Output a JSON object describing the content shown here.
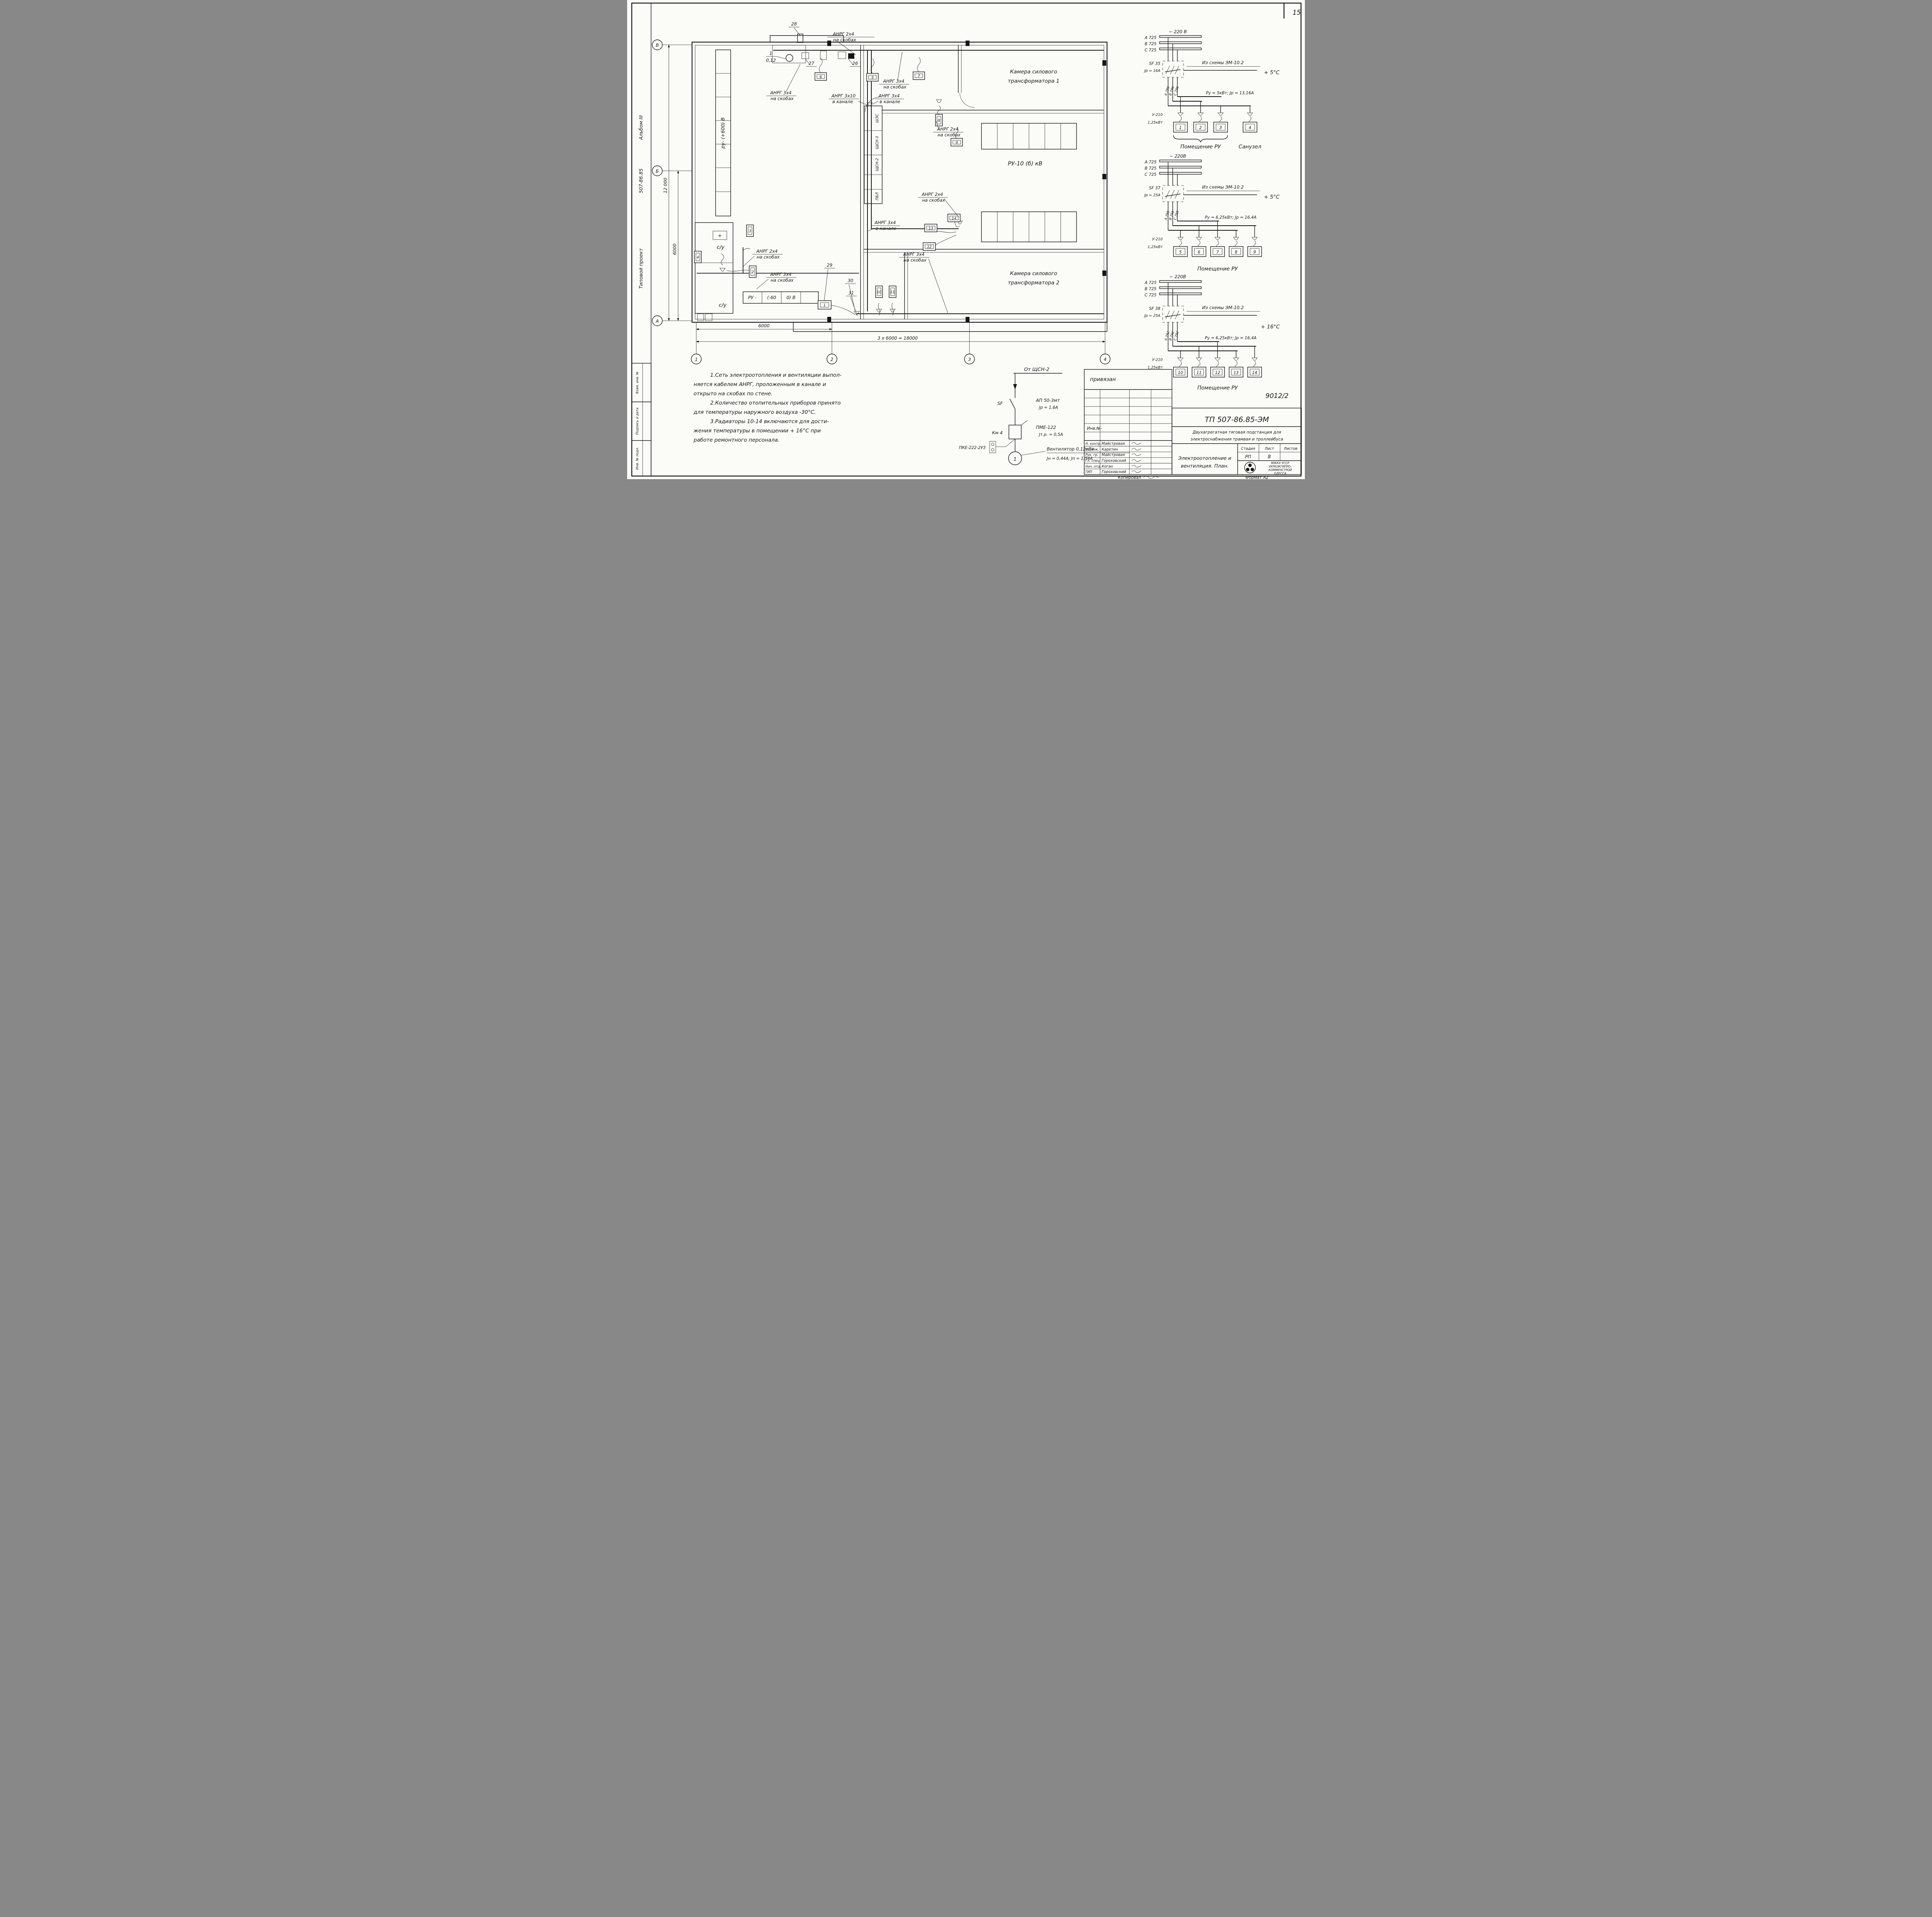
{
  "sheet": {
    "number": "15",
    "ref": "9012/2",
    "copied": "Копировал",
    "format": "Формат А2"
  },
  "side": {
    "album": "Альбом III",
    "project": "507-86.85",
    "type": "Типовой проект",
    "cells": [
      "Взам. инв. №",
      "Подпись и дата",
      "Инв. № подл."
    ]
  },
  "axes": {
    "rows": [
      "В",
      "Б",
      "А"
    ],
    "cols": [
      "1",
      "2",
      "3",
      "4"
    ]
  },
  "dims": {
    "height": "12 000",
    "height2": "6000",
    "span1": "6000",
    "span2": "3 х 6000 = 18000"
  },
  "plan": {
    "trans1_l1": "Камера силового",
    "trans1_l2": "трансформатора 1",
    "trans2_l1": "Камера силового",
    "trans2_l2": "трансформатора 2",
    "ru10": "РУ-10 (б) кВ",
    "plus600": "ру- (+600) В",
    "minus600_1": "РУ -",
    "minus600_2": "(-60",
    "minus600_3": "0) В",
    "su1": "с/у",
    "su2": "с/у",
    "plus": "+",
    "panels": [
      "ШЗС",
      "ЩСН-3",
      "ЩСН-2",
      "ПБЛ"
    ],
    "heaters": [
      "1",
      "2",
      "3",
      "4",
      "5",
      "6",
      "7",
      "8",
      "9",
      "10",
      "11",
      "12",
      "13",
      "14"
    ],
    "callouts": {
      "c26": "26",
      "c27": "27",
      "c28": "28",
      "c29": "29",
      "c30": "30",
      "c31": "31",
      "fan_no": "1",
      "fan_kw": "0,12"
    },
    "cables": {
      "top2x4_1": "АНРГ 2х4",
      "top2x4_2": "на скобах",
      "left3x4_1": "АНРГ 3х4",
      "left3x4_2": "на скобах",
      "right3x4_1": "АНРГ 3х4",
      "right3x4_2": "на скобах",
      "ch3x10_1": "АНРГ 3х10",
      "ch3x10_2": "в канале",
      "ch3x4_1": "АНРГ 3х4",
      "ch3x4_2": "в канале",
      "mid3x4_1": "АНРГ 3х4",
      "mid3x4_2": "в канале",
      "c2x4c_1": "АНРГ 2х4",
      "c2x4c_2": "на скобах",
      "c2x4r_1": "АНРГ 2х4",
      "c2x4r_2": "на скобах",
      "su2x4_1": "АНРГ 2х4",
      "su2x4_2": "на скобах",
      "su3x4_1": "АНРГ 3х4",
      "su3x4_2": "на скобах",
      "bot3x4_1": "АНРГ 3х4",
      "bot3x4_2": "на скобах"
    }
  },
  "circuits": [
    {
      "voltage": "~ 220 В",
      "phases": [
        "А 725",
        "В 725",
        "С 725"
      ],
      "sf": "SF 35",
      "ir": "Jр = 16А",
      "from": "Из схемы ЭМ-10.2",
      "temp": "+ 5°С",
      "wires": [
        "А 796",
        "В 796",
        "С 796"
      ],
      "power": "Ру = 5кВт;  Jр = 13,16А",
      "outlet": "У-210",
      "kw": "1,25кВт",
      "heaters": [
        "1",
        "2",
        "3",
        "4"
      ],
      "room": "Помещение РУ",
      "room2": "Санузел"
    },
    {
      "voltage": "~ 220В",
      "phases": [
        "А 725",
        "В 725",
        "С 725"
      ],
      "sf": "SF 37",
      "ir": "Jр = 25А",
      "from": "Из схемы ЭМ-10.2",
      "temp": "+ 5°С",
      "wires": [
        "А 795",
        "В 795",
        "С 795"
      ],
      "power": "Ру = 6,25кВт;  Jр = 16,4А",
      "outlet": "У-210",
      "kw": "1,25кВт",
      "heaters": [
        "5",
        "6",
        "7",
        "8",
        "9"
      ],
      "room": "Помещение  РУ"
    },
    {
      "voltage": "~ 220В",
      "phases": [
        "А 725",
        "В 725",
        "С 725"
      ],
      "sf": "SF 38",
      "ir": "Jр = 25А",
      "from": "Из схемы ЭМ-10.2",
      "temp": "+ 16°С",
      "wires": [
        "А 792",
        "В 792",
        "С 792"
      ],
      "power": "Ру = 6,25кВт;  Jр = 16,4А",
      "outlet": "У-210",
      "kw": "1,25кВт",
      "heaters": [
        "10",
        "11",
        "12",
        "13",
        "14"
      ],
      "room": "Помещение  РУ"
    }
  ],
  "vent": {
    "from": "От ЩСН-2",
    "sf": "SF",
    "breaker": "АП 50-3мт",
    "breaker_ir": "Jр = 1,6А",
    "km": "Км 4",
    "starter": "ПМЕ-122",
    "starter_ir": "Jт.р. = 0,5А",
    "button": "ПКЕ-222-2У3",
    "fan_no": "1",
    "fan": "Вентилятор 0,12кВт",
    "fan_ir": "Jн = 0,44А;  Jп = 1,54А"
  },
  "notes": {
    "lines": [
      "1.Сеть электроотопления и вентиляции выпол-",
      "няется кабелем АНРГ, проложенным в канале и",
      "открыто на скобах по стене.",
      "2.Количество отопительных приборов принято",
      "для температуры наружного воздуха -30°С.",
      "3.Радиаторы 10-14 включаются для дости-",
      "жения температуры в помещении + 16°С при",
      "работе ремонтного персонала."
    ]
  },
  "tb": {
    "attached": "привязан",
    "inv": "Инв.№-",
    "rows": [
      {
        "role": "Н. контр.",
        "name": "Майстровая"
      },
      {
        "role": "Ст.инж.",
        "name": "Каретин"
      },
      {
        "role": "Рук. гр.",
        "name": "Майстровая"
      },
      {
        "role": "Гл. спец.",
        "name": "Гороховский"
      },
      {
        "role": "Нач. отд.",
        "name": "Коган"
      },
      {
        "role": "ГИП",
        "name": "Гороховский"
      }
    ],
    "doc": "ТП 507-86.85-ЭМ",
    "title1": "Двухагрегатная тяговая подстанция для",
    "title2": "электроснабжения трамвая и троллейбуса",
    "stage_h": "Стадия",
    "sheet_h": "Лист",
    "sheets_h": "Листов",
    "stage": "РП",
    "sheet_no": "8",
    "sub1": "Электроотопление и",
    "sub2": "вентиляция.  План.",
    "org1": "МЖКХ  УССР",
    "org2": "УКРЮЖГИПРО-",
    "org3": "КОММУНСТРОЙ",
    "org4": "ОДЕССА"
  }
}
